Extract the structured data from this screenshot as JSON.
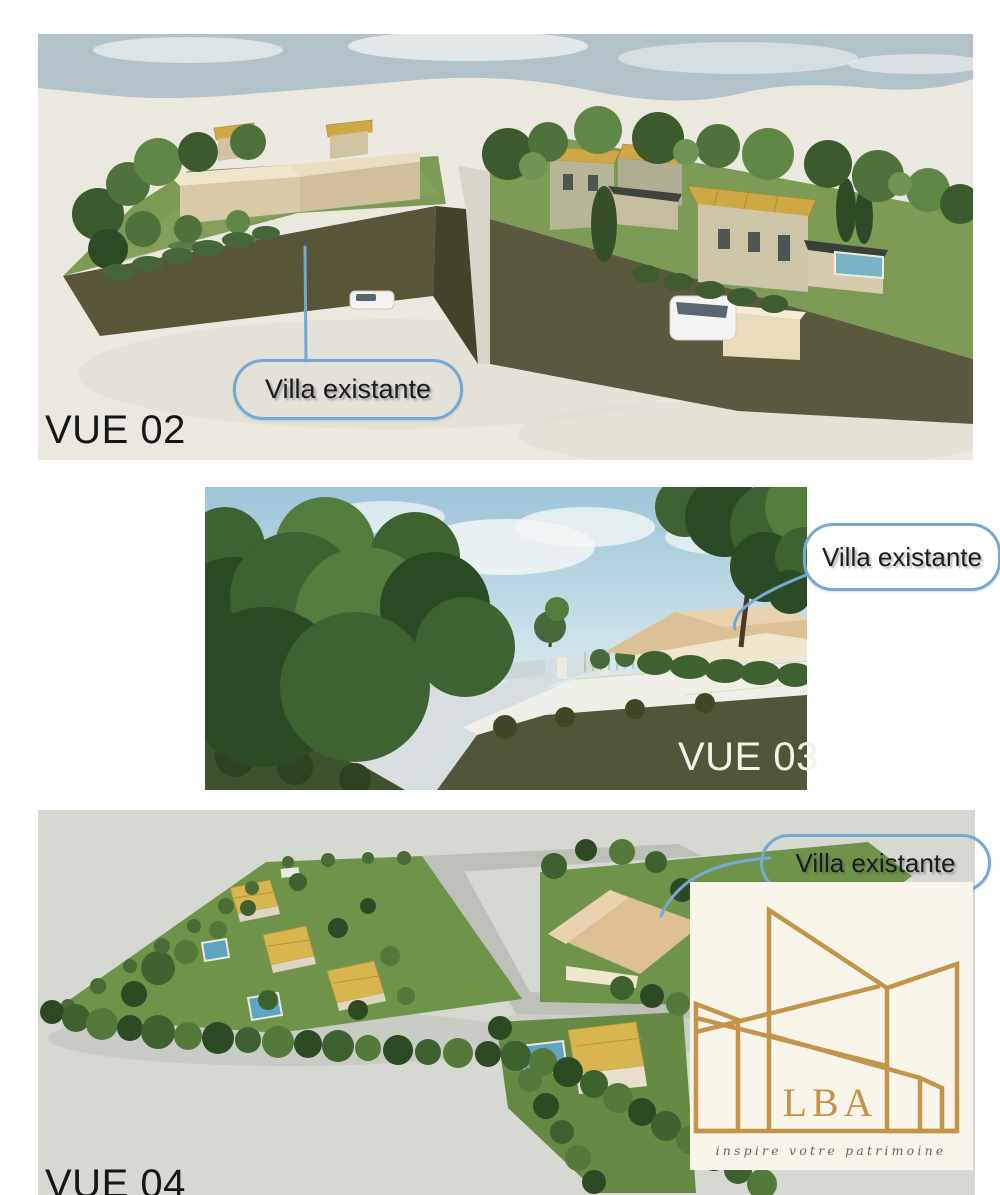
{
  "views": [
    {
      "id": "vue02",
      "label": "VUE 02",
      "callout": "Villa existante"
    },
    {
      "id": "vue03",
      "label": "VUE 03",
      "callout": "Villa existante"
    },
    {
      "id": "vue04",
      "label": "VUE 04",
      "callout": "Villa existante"
    }
  ],
  "logo": {
    "acronym": "LBA",
    "tagline": "inspire votre patrimoine"
  },
  "colors": {
    "page_background": "#ffffff",
    "callout_border": "#74a9d6",
    "callout_text": "#1b1b1b",
    "logo_gold": "#c4944a",
    "logo_background": "#f9f5eb",
    "render1_ground": "#ebe8e0",
    "render1_sky": "#b3c2c8",
    "grass": "#7d9b55",
    "retaining_wall": "#56533a",
    "roof_tile": "#cfa845",
    "pool": "#77b3c3",
    "render3_ground": "#d6d8d2"
  }
}
